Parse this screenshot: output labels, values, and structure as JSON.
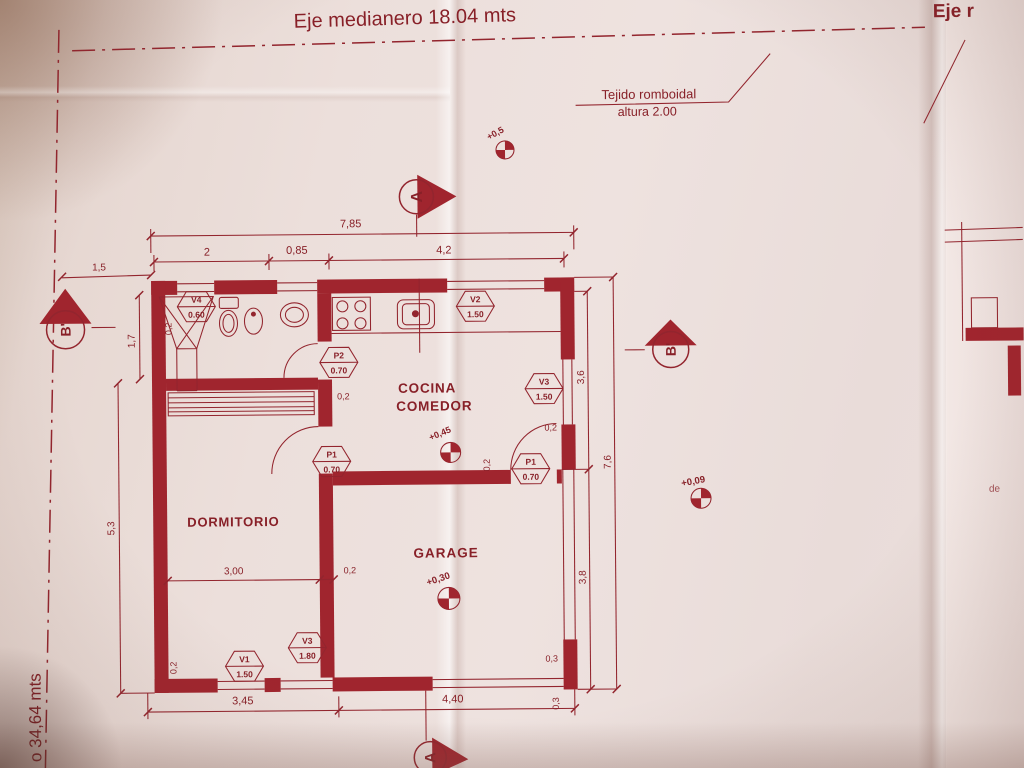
{
  "colors": {
    "ink": "#8c1f27",
    "wall_fill": "#a5242d",
    "paper": "#ecdfdb"
  },
  "boundary": {
    "top": "Eje medianero 18.04 mts",
    "left": "o 34,64 mts",
    "right_sheet": "Eje r",
    "right_sheet_note": "de"
  },
  "fence_note": {
    "line1": "Tejido romboidal",
    "line2": "altura 2.00"
  },
  "rooms": {
    "kitchen1": "COCINA",
    "kitchen2": "COMEDOR",
    "bedroom": "DORMITORIO",
    "garage": "GARAGE"
  },
  "sections": {
    "a_top": "A",
    "a_bottom": "A",
    "b_left": "B'",
    "b_right": "B'"
  },
  "levels": {
    "entry": "+0,5",
    "kitchen": "+0,45",
    "garage": "+0,30",
    "yard": "+0,09"
  },
  "dims": {
    "top_total": "7,85",
    "top_a": "2",
    "top_b": "0,85",
    "top_c": "4,2",
    "setback_left": "1,5",
    "bath_height": "1,7",
    "bedroom_height": "5,3",
    "right_upper": "3,6",
    "right_lower": "3,8",
    "right_total": "7,6",
    "bottom_a": "3,45",
    "bottom_b": "4,40",
    "bedroom_width": "3,00",
    "wall_a": "0,2",
    "wall_b": "0,2",
    "wall_c": "0,2",
    "wall_d": "0,2",
    "wall_e": "0,2",
    "wall_f": "0,2",
    "pillar_a": "0,3",
    "pillar_b": "0,3"
  },
  "openings": [
    {
      "code": "V4",
      "size": "0.60"
    },
    {
      "code": "V2",
      "size": "1.50"
    },
    {
      "code": "P2",
      "size": "0.70"
    },
    {
      "code": "V3",
      "size": "1.50"
    },
    {
      "code": "P1",
      "size": "0.70"
    },
    {
      "code": "P1",
      "size": "0.70"
    },
    {
      "code": "V1",
      "size": "1.50"
    },
    {
      "code": "V3",
      "size": "1.80"
    }
  ]
}
